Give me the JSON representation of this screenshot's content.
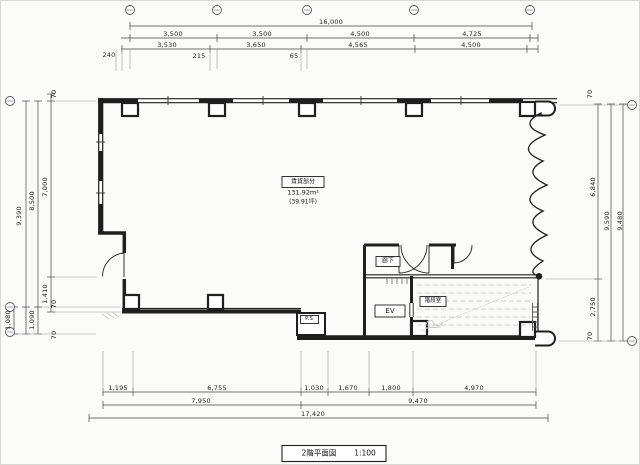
{
  "drawing": {
    "title": "2階平面図",
    "scale": "1:100",
    "paper_color": "#fbfbf9",
    "ink_color": "#1f1f1f",
    "hatch_color": "#bdbdbd"
  },
  "room": {
    "name": "賃貸部分",
    "area_m2": "131.92m²",
    "area_tsubo": "(39.91坪)"
  },
  "labels": {
    "corridor": "廊下",
    "elevator": "EV",
    "stairwell": "階段室",
    "pipe_space": "P.S"
  },
  "dims_top": {
    "total": "16,000",
    "row1": [
      "3,500",
      "3,500",
      "4,500",
      "4,725"
    ],
    "row2": [
      "3,530",
      "3,650",
      "4,565",
      "4,500"
    ],
    "small": [
      "240",
      "215",
      "65"
    ]
  },
  "dims_bottom": {
    "row1": [
      "1,195",
      "6,755",
      "1,030",
      "1,670",
      "1,800",
      "4,970"
    ],
    "row2": [
      "7,950",
      "9,470"
    ],
    "total": "17,420"
  },
  "dims_left": {
    "small_top": "70",
    "overall": "9,390",
    "mid": "8,500",
    "upper": "7,000",
    "lower": "1,410",
    "small_mid": "70",
    "bottom_outer": "1,080",
    "bottom_inner": "1,090",
    "small_bottom": "70"
  },
  "dims_right": {
    "small_top": "70",
    "upper": "6,840",
    "overall_inner": "9,590",
    "overall_outer": "9,480",
    "lower": "2,750",
    "small_bottom": "70"
  }
}
